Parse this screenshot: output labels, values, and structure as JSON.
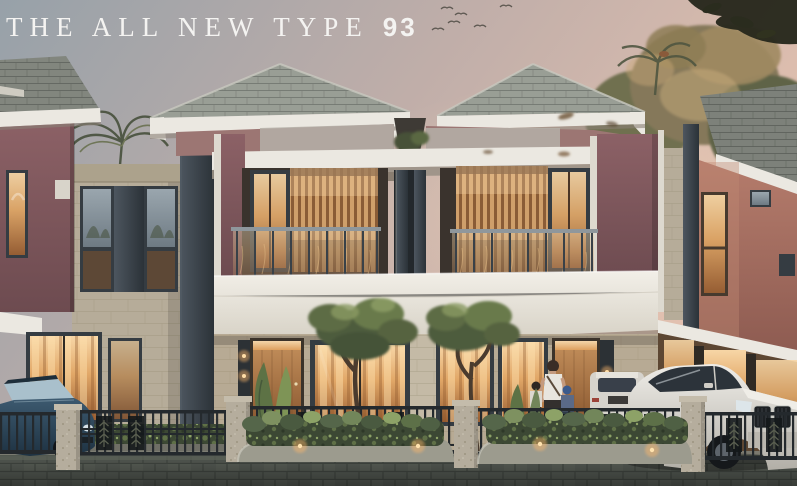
{
  "title": {
    "text": "THE ALL NEW TYPE",
    "number": "93"
  },
  "colors": {
    "title-color": "#f4f3f1",
    "sky-top": "#97a1a9",
    "sky-mid": "#c0aea9",
    "sky-warm": "#e5c2b0",
    "roof-shingle": "#999e95",
    "roof-dark": "#7a7f78",
    "roof-line": "#6e736c",
    "fascia-white": "#ebe8e1",
    "wall-maroon": "#7c575b",
    "wall-maroon-light": "#9c7673",
    "wall-terracotta": "#a66f63",
    "stone-light": "#b6ac99",
    "stone-line": "#a0967f",
    "frame-dark": "#353c42",
    "glow-bright": "#f7d6a6",
    "glow-warm": "#e2a868",
    "glow-deep": "#9a5f33",
    "wood-slat": "#cf9f6a",
    "wood-slat-dark": "#8a5c36",
    "wood-door": "#c4905c",
    "green-dark": "#3c4834",
    "green-mid": "#5f7047",
    "green-light": "#8da267",
    "fence-metal": "#24292d",
    "pillar-stone": "#b5ad9d",
    "curb": "#9c9b8e",
    "road-paver": "#4c514b",
    "road-joint": "#3b403b",
    "car-dark-body": "#2e4a5e",
    "car-glass": "#a9c0cc",
    "suv-white": "#dcd9d2",
    "shirt-white": "#e8e5de",
    "skin": "#c49a7e",
    "bird": "#4f4c45"
  }
}
